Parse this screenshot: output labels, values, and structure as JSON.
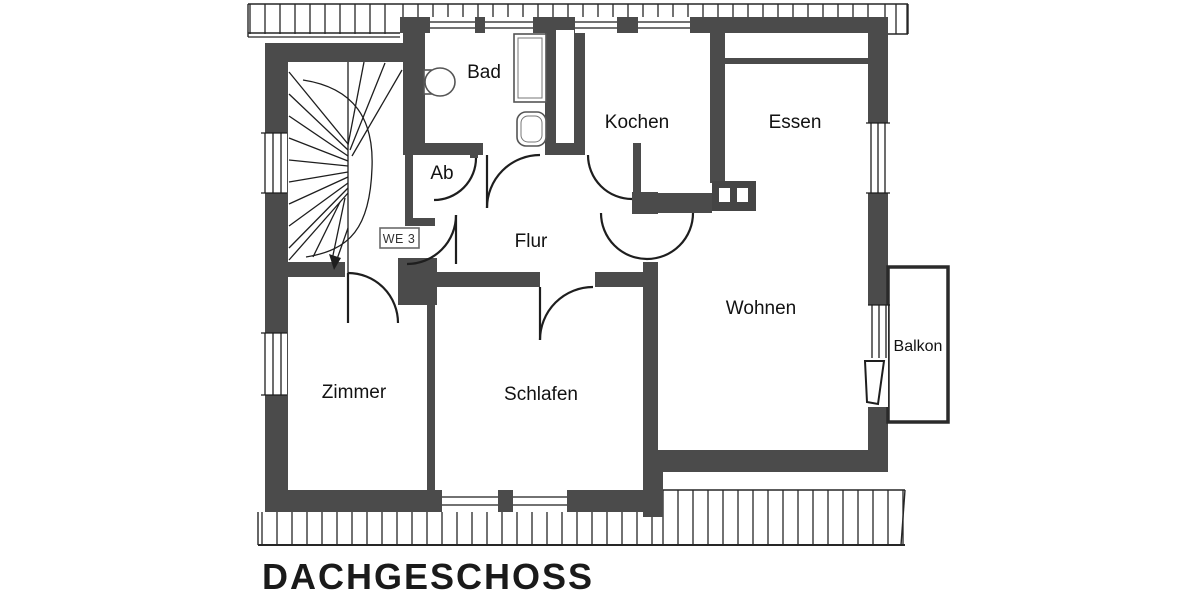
{
  "title": "DACHGESCHOSS",
  "unit_label": "WE 3",
  "rooms": [
    {
      "id": "bad",
      "label": "Bad"
    },
    {
      "id": "kochen",
      "label": "Kochen"
    },
    {
      "id": "essen",
      "label": "Essen"
    },
    {
      "id": "ab",
      "label": "Ab"
    },
    {
      "id": "flur",
      "label": "Flur"
    },
    {
      "id": "wohnen",
      "label": "Wohnen"
    },
    {
      "id": "zimmer",
      "label": "Zimmer"
    },
    {
      "id": "schlafen",
      "label": "Schlafen"
    },
    {
      "id": "balkon",
      "label": "Balkon"
    }
  ],
  "colors": {
    "wall": "#4b4b4b",
    "line": "#1e1e1e",
    "background": "#ffffff"
  }
}
